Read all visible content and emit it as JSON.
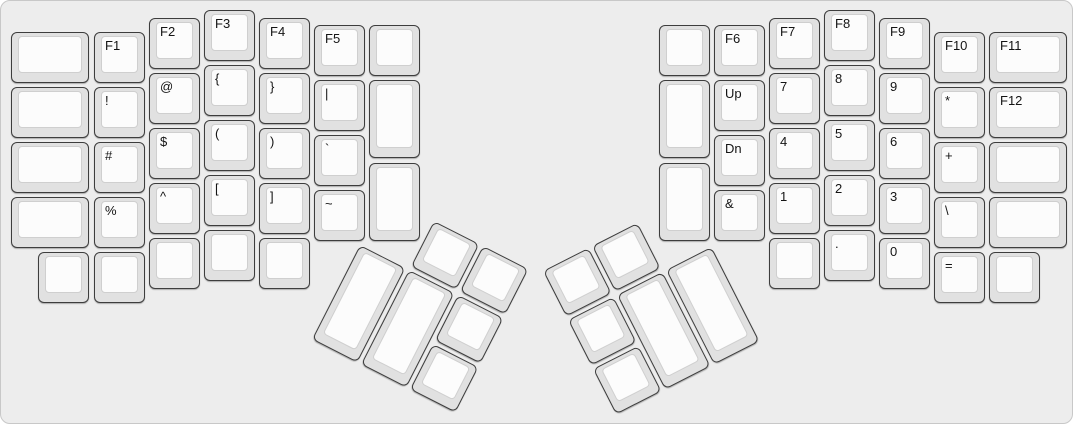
{
  "canvas": {
    "width": 1073,
    "height": 424,
    "bg": "#ededed",
    "border": "#c8c8c8"
  },
  "key_style": {
    "base_fill": "#e1e1e1",
    "base_border": "#3d3d3d",
    "top_fill": "#fcfcfc",
    "top_border": "#cfcfcf",
    "label_color": "#141414"
  },
  "left_main": {
    "keys": [
      {
        "l": "",
        "x": 10,
        "y": 31,
        "w": 78,
        "h": 51
      },
      {
        "l": "",
        "x": 10,
        "y": 86,
        "w": 78,
        "h": 51
      },
      {
        "l": "",
        "x": 10,
        "y": 141,
        "w": 78,
        "h": 51
      },
      {
        "l": "",
        "x": 10,
        "y": 196,
        "w": 78,
        "h": 51
      },
      {
        "l": "",
        "x": 37,
        "y": 251,
        "w": 51,
        "h": 51
      },
      {
        "l": "F1",
        "x": 93,
        "y": 31,
        "w": 51,
        "h": 51
      },
      {
        "l": "!",
        "x": 93,
        "y": 86,
        "w": 51,
        "h": 51
      },
      {
        "l": "#",
        "x": 93,
        "y": 141,
        "w": 51,
        "h": 51
      },
      {
        "l": "%",
        "x": 93,
        "y": 196,
        "w": 51,
        "h": 51
      },
      {
        "l": "",
        "x": 93,
        "y": 251,
        "w": 51,
        "h": 51
      },
      {
        "l": "F2",
        "x": 148,
        "y": 17,
        "w": 51,
        "h": 51
      },
      {
        "l": "@",
        "x": 148,
        "y": 72,
        "w": 51,
        "h": 51
      },
      {
        "l": "$",
        "x": 148,
        "y": 127,
        "w": 51,
        "h": 51
      },
      {
        "l": "^",
        "x": 148,
        "y": 182,
        "w": 51,
        "h": 51
      },
      {
        "l": "",
        "x": 148,
        "y": 237,
        "w": 51,
        "h": 51
      },
      {
        "l": "F3",
        "x": 203,
        "y": 9,
        "w": 51,
        "h": 51
      },
      {
        "l": "{",
        "x": 203,
        "y": 64,
        "w": 51,
        "h": 51
      },
      {
        "l": "(",
        "x": 203,
        "y": 119,
        "w": 51,
        "h": 51
      },
      {
        "l": "[",
        "x": 203,
        "y": 174,
        "w": 51,
        "h": 51
      },
      {
        "l": "",
        "x": 203,
        "y": 229,
        "w": 51,
        "h": 51
      },
      {
        "l": "F4",
        "x": 258,
        "y": 17,
        "w": 51,
        "h": 51
      },
      {
        "l": "}",
        "x": 258,
        "y": 72,
        "w": 51,
        "h": 51
      },
      {
        "l": ")",
        "x": 258,
        "y": 127,
        "w": 51,
        "h": 51
      },
      {
        "l": "]",
        "x": 258,
        "y": 182,
        "w": 51,
        "h": 51
      },
      {
        "l": "",
        "x": 258,
        "y": 237,
        "w": 51,
        "h": 51
      },
      {
        "l": "F5",
        "x": 313,
        "y": 24,
        "w": 51,
        "h": 51
      },
      {
        "l": "|",
        "x": 313,
        "y": 79,
        "w": 51,
        "h": 51
      },
      {
        "l": "`",
        "x": 313,
        "y": 134,
        "w": 51,
        "h": 51
      },
      {
        "l": "~",
        "x": 313,
        "y": 189,
        "w": 51,
        "h": 51
      },
      {
        "l": "",
        "x": 368,
        "y": 24,
        "w": 51,
        "h": 51
      },
      {
        "l": "",
        "x": 368,
        "y": 79,
        "w": 51,
        "h": 78
      },
      {
        "l": "",
        "x": 368,
        "y": 162,
        "w": 51,
        "h": 78
      }
    ]
  },
  "right_main": {
    "keys": [
      {
        "l": "",
        "x": 658,
        "y": 24,
        "w": 51,
        "h": 51
      },
      {
        "l": "",
        "x": 658,
        "y": 79,
        "w": 51,
        "h": 78
      },
      {
        "l": "",
        "x": 658,
        "y": 162,
        "w": 51,
        "h": 78
      },
      {
        "l": "F6",
        "x": 713,
        "y": 24,
        "w": 51,
        "h": 51
      },
      {
        "l": "Up",
        "x": 713,
        "y": 79,
        "w": 51,
        "h": 51
      },
      {
        "l": "Dn",
        "x": 713,
        "y": 134,
        "w": 51,
        "h": 51
      },
      {
        "l": "&",
        "x": 713,
        "y": 189,
        "w": 51,
        "h": 51
      },
      {
        "l": "F7",
        "x": 768,
        "y": 17,
        "w": 51,
        "h": 51
      },
      {
        "l": "7",
        "x": 768,
        "y": 72,
        "w": 51,
        "h": 51
      },
      {
        "l": "4",
        "x": 768,
        "y": 127,
        "w": 51,
        "h": 51
      },
      {
        "l": "1",
        "x": 768,
        "y": 182,
        "w": 51,
        "h": 51
      },
      {
        "l": "",
        "x": 768,
        "y": 237,
        "w": 51,
        "h": 51
      },
      {
        "l": "F8",
        "x": 823,
        "y": 9,
        "w": 51,
        "h": 51
      },
      {
        "l": "8",
        "x": 823,
        "y": 64,
        "w": 51,
        "h": 51
      },
      {
        "l": "5",
        "x": 823,
        "y": 119,
        "w": 51,
        "h": 51
      },
      {
        "l": "2",
        "x": 823,
        "y": 174,
        "w": 51,
        "h": 51
      },
      {
        "l": ".",
        "x": 823,
        "y": 229,
        "w": 51,
        "h": 51
      },
      {
        "l": "F9",
        "x": 878,
        "y": 17,
        "w": 51,
        "h": 51
      },
      {
        "l": "9",
        "x": 878,
        "y": 72,
        "w": 51,
        "h": 51
      },
      {
        "l": "6",
        "x": 878,
        "y": 127,
        "w": 51,
        "h": 51
      },
      {
        "l": "3",
        "x": 878,
        "y": 182,
        "w": 51,
        "h": 51
      },
      {
        "l": "0",
        "x": 878,
        "y": 237,
        "w": 51,
        "h": 51
      },
      {
        "l": "F10",
        "x": 933,
        "y": 31,
        "w": 51,
        "h": 51
      },
      {
        "l": "*",
        "x": 933,
        "y": 86,
        "w": 51,
        "h": 51
      },
      {
        "l": "+",
        "x": 933,
        "y": 141,
        "w": 51,
        "h": 51
      },
      {
        "l": "\\",
        "x": 933,
        "y": 196,
        "w": 51,
        "h": 51
      },
      {
        "l": "=",
        "x": 933,
        "y": 251,
        "w": 51,
        "h": 51
      },
      {
        "l": "F11",
        "x": 988,
        "y": 31,
        "w": 78,
        "h": 51
      },
      {
        "l": "F12",
        "x": 988,
        "y": 86,
        "w": 78,
        "h": 51
      },
      {
        "l": "",
        "x": 988,
        "y": 141,
        "w": 78,
        "h": 51
      },
      {
        "l": "",
        "x": 988,
        "y": 196,
        "w": 78,
        "h": 51
      },
      {
        "l": "",
        "x": 988,
        "y": 251,
        "w": 51,
        "h": 51
      }
    ]
  },
  "left_thumb": {
    "anchor_x": 384,
    "anchor_y": 195,
    "angle_deg": 27,
    "keys": [
      {
        "l": "",
        "x": 55,
        "y": 0,
        "w": 51,
        "h": 51
      },
      {
        "l": "",
        "x": 110,
        "y": 0,
        "w": 51,
        "h": 51
      },
      {
        "l": "",
        "x": 0,
        "y": 55,
        "w": 51,
        "h": 106
      },
      {
        "l": "",
        "x": 55,
        "y": 55,
        "w": 51,
        "h": 106
      },
      {
        "l": "",
        "x": 110,
        "y": 55,
        "w": 51,
        "h": 51
      },
      {
        "l": "",
        "x": 110,
        "y": 110,
        "w": 51,
        "h": 51
      }
    ]
  },
  "right_thumb": {
    "anchor_x": 542,
    "anchor_y": 270,
    "angle_deg": -27,
    "keys": [
      {
        "l": "",
        "x": 0,
        "y": 0,
        "w": 51,
        "h": 51
      },
      {
        "l": "",
        "x": 55,
        "y": 0,
        "w": 51,
        "h": 51
      },
      {
        "l": "",
        "x": 0,
        "y": 55,
        "w": 51,
        "h": 51
      },
      {
        "l": "",
        "x": 55,
        "y": 55,
        "w": 51,
        "h": 106
      },
      {
        "l": "",
        "x": 110,
        "y": 55,
        "w": 51,
        "h": 106
      },
      {
        "l": "",
        "x": 0,
        "y": 110,
        "w": 51,
        "h": 51
      }
    ]
  }
}
